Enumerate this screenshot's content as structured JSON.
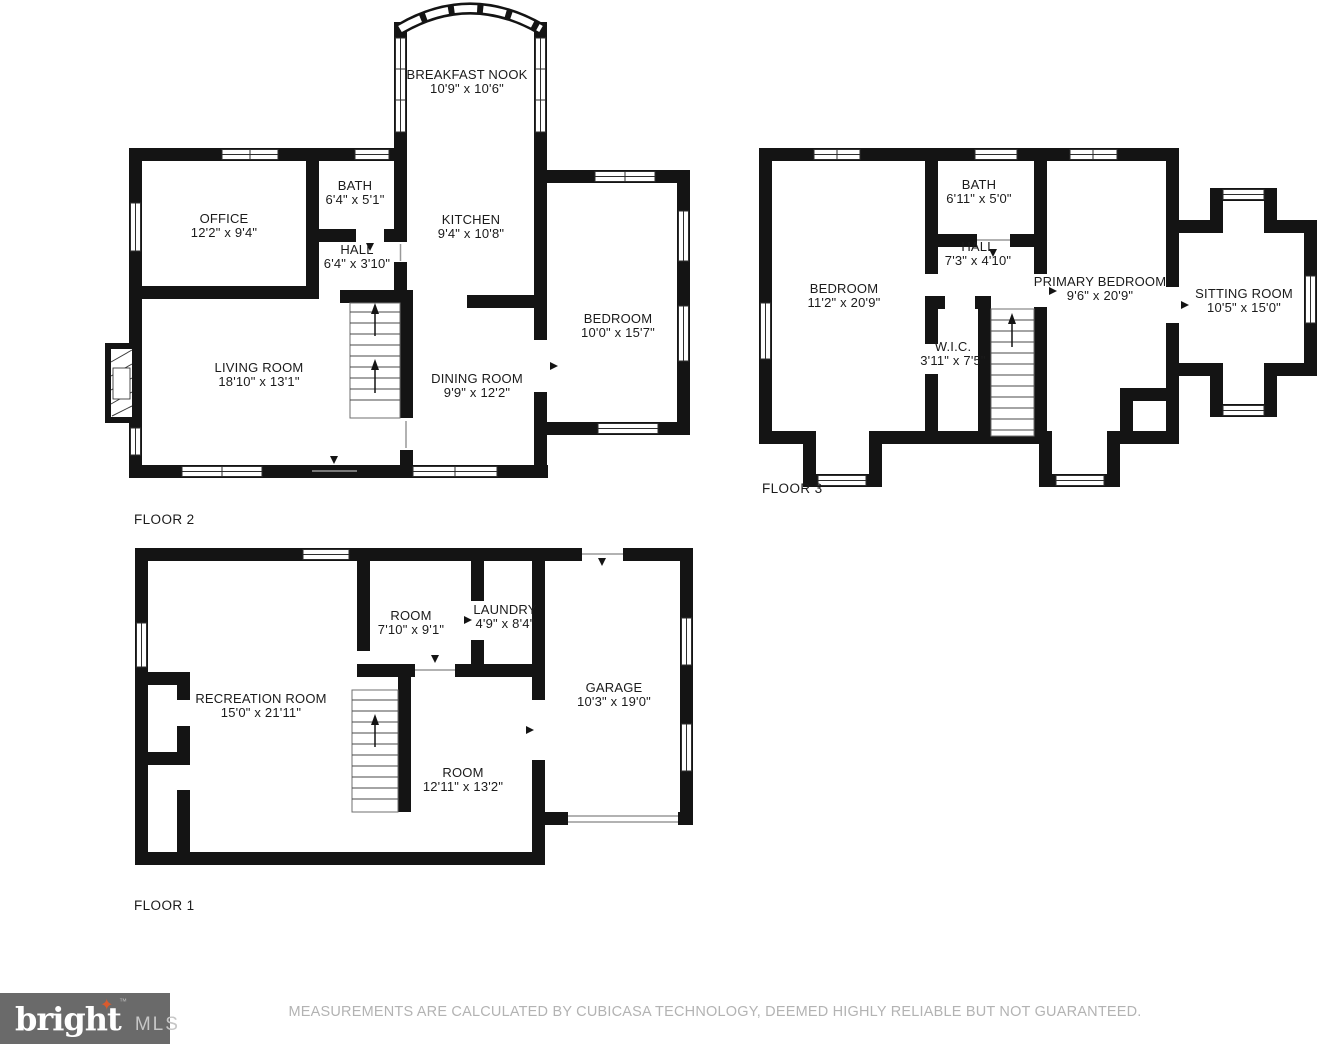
{
  "floors": [
    {
      "label": "FLOOR 2",
      "rooms": [
        {
          "name": "BREAKFAST NOOK",
          "dims": "10'9\" x 10'6\""
        },
        {
          "name": "OFFICE",
          "dims": "12'2\" x 9'4\""
        },
        {
          "name": "BATH",
          "dims": "6'4\" x 5'1\""
        },
        {
          "name": "HALL",
          "dims": "6'4\" x 3'10\""
        },
        {
          "name": "KITCHEN",
          "dims": "9'4\" x 10'8\""
        },
        {
          "name": "BEDROOM",
          "dims": "10'0\" x 15'7\""
        },
        {
          "name": "LIVING ROOM",
          "dims": "18'10\" x 13'1\""
        },
        {
          "name": "DINING ROOM",
          "dims": "9'9\" x 12'2\""
        }
      ]
    },
    {
      "label": "FLOOR 3",
      "rooms": [
        {
          "name": "BEDROOM",
          "dims": "11'2\" x 20'9\""
        },
        {
          "name": "BATH",
          "dims": "6'11\" x 5'0\""
        },
        {
          "name": "HALL",
          "dims": "7'3\" x 4'10\""
        },
        {
          "name": "W.I.C.",
          "dims": "3'11\" x 7'5\""
        },
        {
          "name": "PRIMARY BEDROOM",
          "dims": "9'6\" x 20'9\""
        },
        {
          "name": "SITTING ROOM",
          "dims": "10'5\" x 15'0\""
        }
      ]
    },
    {
      "label": "FLOOR 1",
      "rooms": [
        {
          "name": "RECREATION ROOM",
          "dims": "15'0\" x 21'11\""
        },
        {
          "name": "ROOM",
          "dims": "7'10\" x 9'1\""
        },
        {
          "name": "LAUNDRY",
          "dims": "4'9\" x 8'4\""
        },
        {
          "name": "GARAGE",
          "dims": "10'3\" x 19'0\""
        },
        {
          "name": "ROOM",
          "dims": "12'11\" x 13'2\""
        }
      ]
    }
  ],
  "footer": {
    "brand": "bright",
    "brand_tm": "™",
    "brand_suffix": "MLS",
    "brand_bg": "#6a6a6a",
    "star_icon": "✦",
    "star_color": "#d95b2e",
    "disclaimer": "MEASUREMENTS ARE CALCULATED BY CUBICASA TECHNOLOGY, DEEMED HIGHLY RELIABLE BUT NOT GUARANTEED."
  },
  "colors": {
    "wall": "#141414"
  }
}
